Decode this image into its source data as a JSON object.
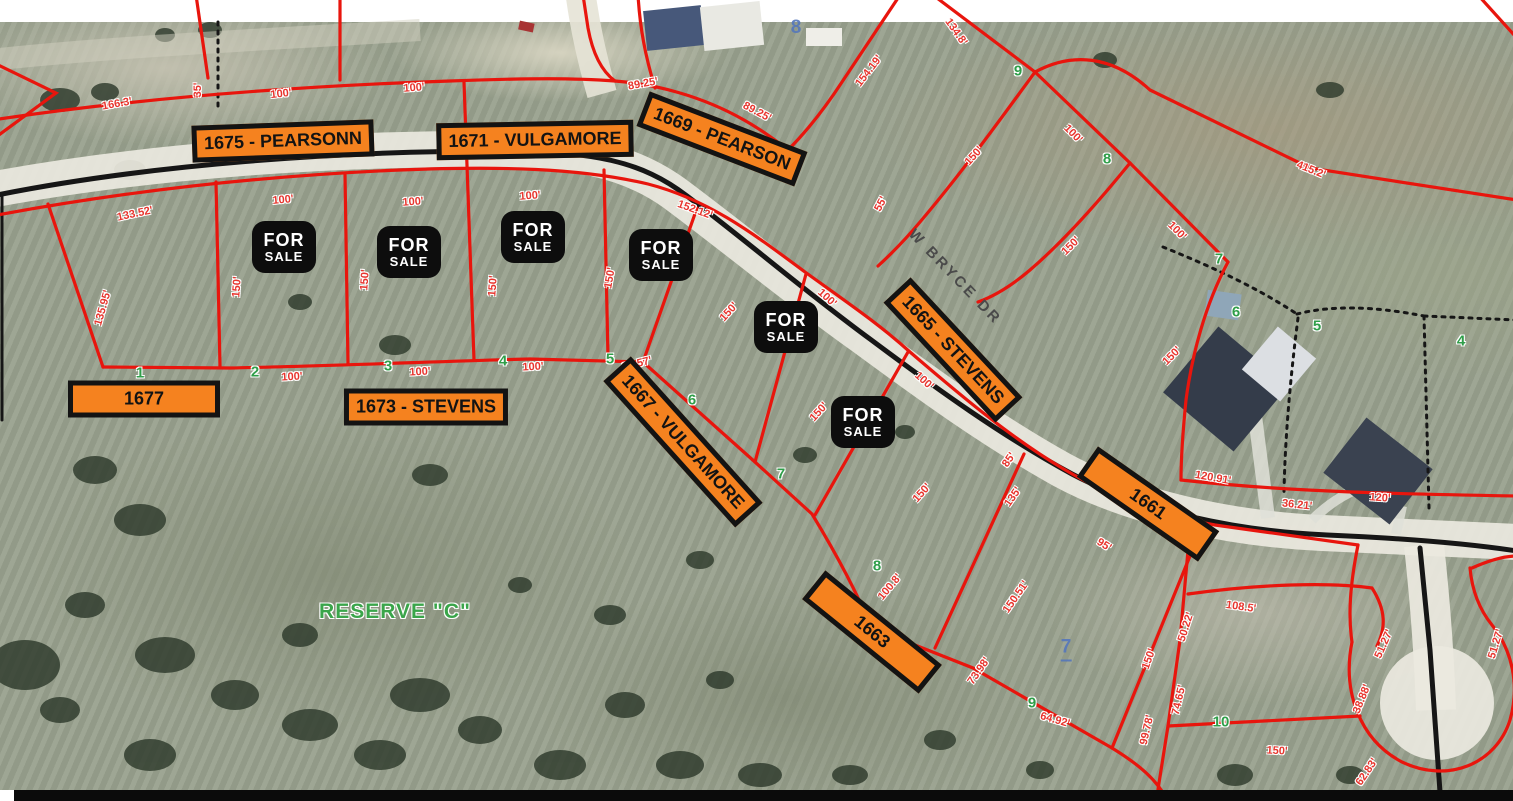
{
  "map": {
    "street_label": "W BRYCE DR",
    "reserve_label": "RESERVE \"C\"",
    "colors": {
      "badge_orange": "#F5821F",
      "badge_border_black": "#131313",
      "lot_line_red": "#E8150D",
      "dimension_red": "#E8352E",
      "lot_number_green": "#2F9E49",
      "reserve_green": "#3AA54A",
      "note_blue": "#5577BB",
      "road_line_black": "#161616",
      "for_sale_bg": "#0D0D0D"
    },
    "address_badges": [
      {
        "label": "1675 - PEARSONN",
        "cx": 283,
        "cy": 141,
        "rot": -2
      },
      {
        "label": "1671 - VULGAMORE",
        "cx": 535,
        "cy": 140,
        "rot": -1
      },
      {
        "label": "1669 - PEARSON",
        "cx": 722,
        "cy": 139,
        "rot": 21
      },
      {
        "label": "1665 - STEVENS",
        "cx": 953,
        "cy": 350,
        "rot": 47
      },
      {
        "label": "1677",
        "cx": 144,
        "cy": 399,
        "rot": 0,
        "minw": 152
      },
      {
        "label": "1673 - STEVENS",
        "cx": 426,
        "cy": 407,
        "rot": 0
      },
      {
        "label": "1667 - VULGAMORE",
        "cx": 683,
        "cy": 442,
        "rot": 48
      },
      {
        "label": "1661",
        "cx": 1148,
        "cy": 504,
        "rot": 35,
        "minw": 148
      },
      {
        "label": "1663",
        "cx": 872,
        "cy": 632,
        "rot": 39,
        "minw": 150
      }
    ],
    "for_sale_signs": {
      "line1": "FOR",
      "line2": "SALE",
      "positions": [
        {
          "cx": 284,
          "cy": 247
        },
        {
          "cx": 409,
          "cy": 252
        },
        {
          "cx": 533,
          "cy": 237
        },
        {
          "cx": 661,
          "cy": 255
        },
        {
          "cx": 786,
          "cy": 327
        },
        {
          "cx": 863,
          "cy": 422
        }
      ]
    },
    "dimension_labels": [
      {
        "t": "166.3'",
        "x": 117,
        "y": 104,
        "r": -10
      },
      {
        "t": "35'",
        "x": 198,
        "y": 90,
        "r": -90
      },
      {
        "t": "100'",
        "x": 281,
        "y": 94,
        "r": -6
      },
      {
        "t": "100'",
        "x": 414,
        "y": 88,
        "r": -4
      },
      {
        "t": "89.25'",
        "x": 643,
        "y": 84,
        "r": -10
      },
      {
        "t": "89.25'",
        "x": 757,
        "y": 112,
        "r": 28
      },
      {
        "t": "134.8'",
        "x": 956,
        "y": 32,
        "r": 55
      },
      {
        "t": "154.19'",
        "x": 869,
        "y": 71,
        "r": -52
      },
      {
        "t": "415.2'",
        "x": 1311,
        "y": 170,
        "r": 22
      },
      {
        "t": "100'",
        "x": 1073,
        "y": 134,
        "r": 45
      },
      {
        "t": "150'",
        "x": 974,
        "y": 156,
        "r": -48
      },
      {
        "t": "150'",
        "x": 1071,
        "y": 246,
        "r": -45
      },
      {
        "t": "100'",
        "x": 1177,
        "y": 231,
        "r": 45
      },
      {
        "t": "55'",
        "x": 881,
        "y": 204,
        "r": -62
      },
      {
        "t": "152.12'",
        "x": 695,
        "y": 210,
        "r": 20
      },
      {
        "t": "100'",
        "x": 283,
        "y": 200,
        "r": -5
      },
      {
        "t": "100'",
        "x": 413,
        "y": 202,
        "r": -4
      },
      {
        "t": "100'",
        "x": 530,
        "y": 196,
        "r": -4
      },
      {
        "t": "150'",
        "x": 237,
        "y": 287,
        "r": -86
      },
      {
        "t": "150'",
        "x": 365,
        "y": 280,
        "r": -86
      },
      {
        "t": "150'",
        "x": 493,
        "y": 286,
        "r": -86
      },
      {
        "t": "150'",
        "x": 610,
        "y": 278,
        "r": -80
      },
      {
        "t": "133.52'",
        "x": 135,
        "y": 214,
        "r": -12
      },
      {
        "t": "135.95'",
        "x": 103,
        "y": 308,
        "r": -74
      },
      {
        "t": "100'",
        "x": 292,
        "y": 377,
        "r": -3
      },
      {
        "t": "100'",
        "x": 420,
        "y": 372,
        "r": -3
      },
      {
        "t": "100'",
        "x": 533,
        "y": 367,
        "r": -3
      },
      {
        "t": "23.57'",
        "x": 637,
        "y": 364,
        "r": -14
      },
      {
        "t": "100'",
        "x": 827,
        "y": 298,
        "r": 42
      },
      {
        "t": "150'",
        "x": 729,
        "y": 312,
        "r": -48
      },
      {
        "t": "100'",
        "x": 924,
        "y": 381,
        "r": 42
      },
      {
        "t": "150'",
        "x": 819,
        "y": 412,
        "r": -48
      },
      {
        "t": "150'",
        "x": 922,
        "y": 493,
        "r": -48
      },
      {
        "t": "85'",
        "x": 1009,
        "y": 460,
        "r": -55
      },
      {
        "t": "135'",
        "x": 1013,
        "y": 497,
        "r": -55
      },
      {
        "t": "95'",
        "x": 1104,
        "y": 545,
        "r": 32
      },
      {
        "t": "150'",
        "x": 1172,
        "y": 356,
        "r": -45
      },
      {
        "t": "120.91'",
        "x": 1213,
        "y": 478,
        "r": 10
      },
      {
        "t": "36.21'",
        "x": 1297,
        "y": 505,
        "r": 6
      },
      {
        "t": "120'",
        "x": 1380,
        "y": 498,
        "r": 4
      },
      {
        "t": "150.51'",
        "x": 1016,
        "y": 597,
        "r": -55
      },
      {
        "t": "100.8'",
        "x": 890,
        "y": 587,
        "r": -50
      },
      {
        "t": "64.92'",
        "x": 1055,
        "y": 720,
        "r": 16
      },
      {
        "t": "73.98'",
        "x": 979,
        "y": 671,
        "r": -55
      },
      {
        "t": "150'",
        "x": 1149,
        "y": 659,
        "r": -70
      },
      {
        "t": "50.22'",
        "x": 1186,
        "y": 627,
        "r": -72
      },
      {
        "t": "74.65'",
        "x": 1179,
        "y": 700,
        "r": -77
      },
      {
        "t": "99.78'",
        "x": 1147,
        "y": 730,
        "r": -77
      },
      {
        "t": "108.5'",
        "x": 1241,
        "y": 607,
        "r": 8
      },
      {
        "t": "51.27'",
        "x": 1384,
        "y": 644,
        "r": -66
      },
      {
        "t": "51.27'",
        "x": 1496,
        "y": 644,
        "r": -73
      },
      {
        "t": "38.88'",
        "x": 1362,
        "y": 699,
        "r": -68
      },
      {
        "t": "62.83'",
        "x": 1367,
        "y": 772,
        "r": -56
      },
      {
        "t": "150'",
        "x": 1277,
        "y": 751,
        "r": 3
      }
    ],
    "lot_numbers_green": [
      {
        "n": "1",
        "x": 140,
        "y": 373
      },
      {
        "n": "2",
        "x": 255,
        "y": 372
      },
      {
        "n": "3",
        "x": 388,
        "y": 366
      },
      {
        "n": "4",
        "x": 503,
        "y": 361
      },
      {
        "n": "5",
        "x": 610,
        "y": 359
      },
      {
        "n": "6",
        "x": 692,
        "y": 400
      },
      {
        "n": "7",
        "x": 781,
        "y": 474
      },
      {
        "n": "8",
        "x": 877,
        "y": 566
      },
      {
        "n": "9",
        "x": 1032,
        "y": 703
      },
      {
        "n": "10",
        "x": 1221,
        "y": 722
      },
      {
        "n": "9",
        "x": 1018,
        "y": 71
      },
      {
        "n": "8",
        "x": 1107,
        "y": 159
      },
      {
        "n": "7",
        "x": 1219,
        "y": 259
      },
      {
        "n": "6",
        "x": 1236,
        "y": 312
      },
      {
        "n": "5",
        "x": 1317,
        "y": 326
      },
      {
        "n": "4",
        "x": 1461,
        "y": 341
      }
    ],
    "lot_numbers_blue": [
      {
        "n": "8",
        "x": 796,
        "y": 28,
        "underline": false
      },
      {
        "n": "7",
        "x": 1066,
        "y": 649,
        "underline": true
      }
    ]
  }
}
